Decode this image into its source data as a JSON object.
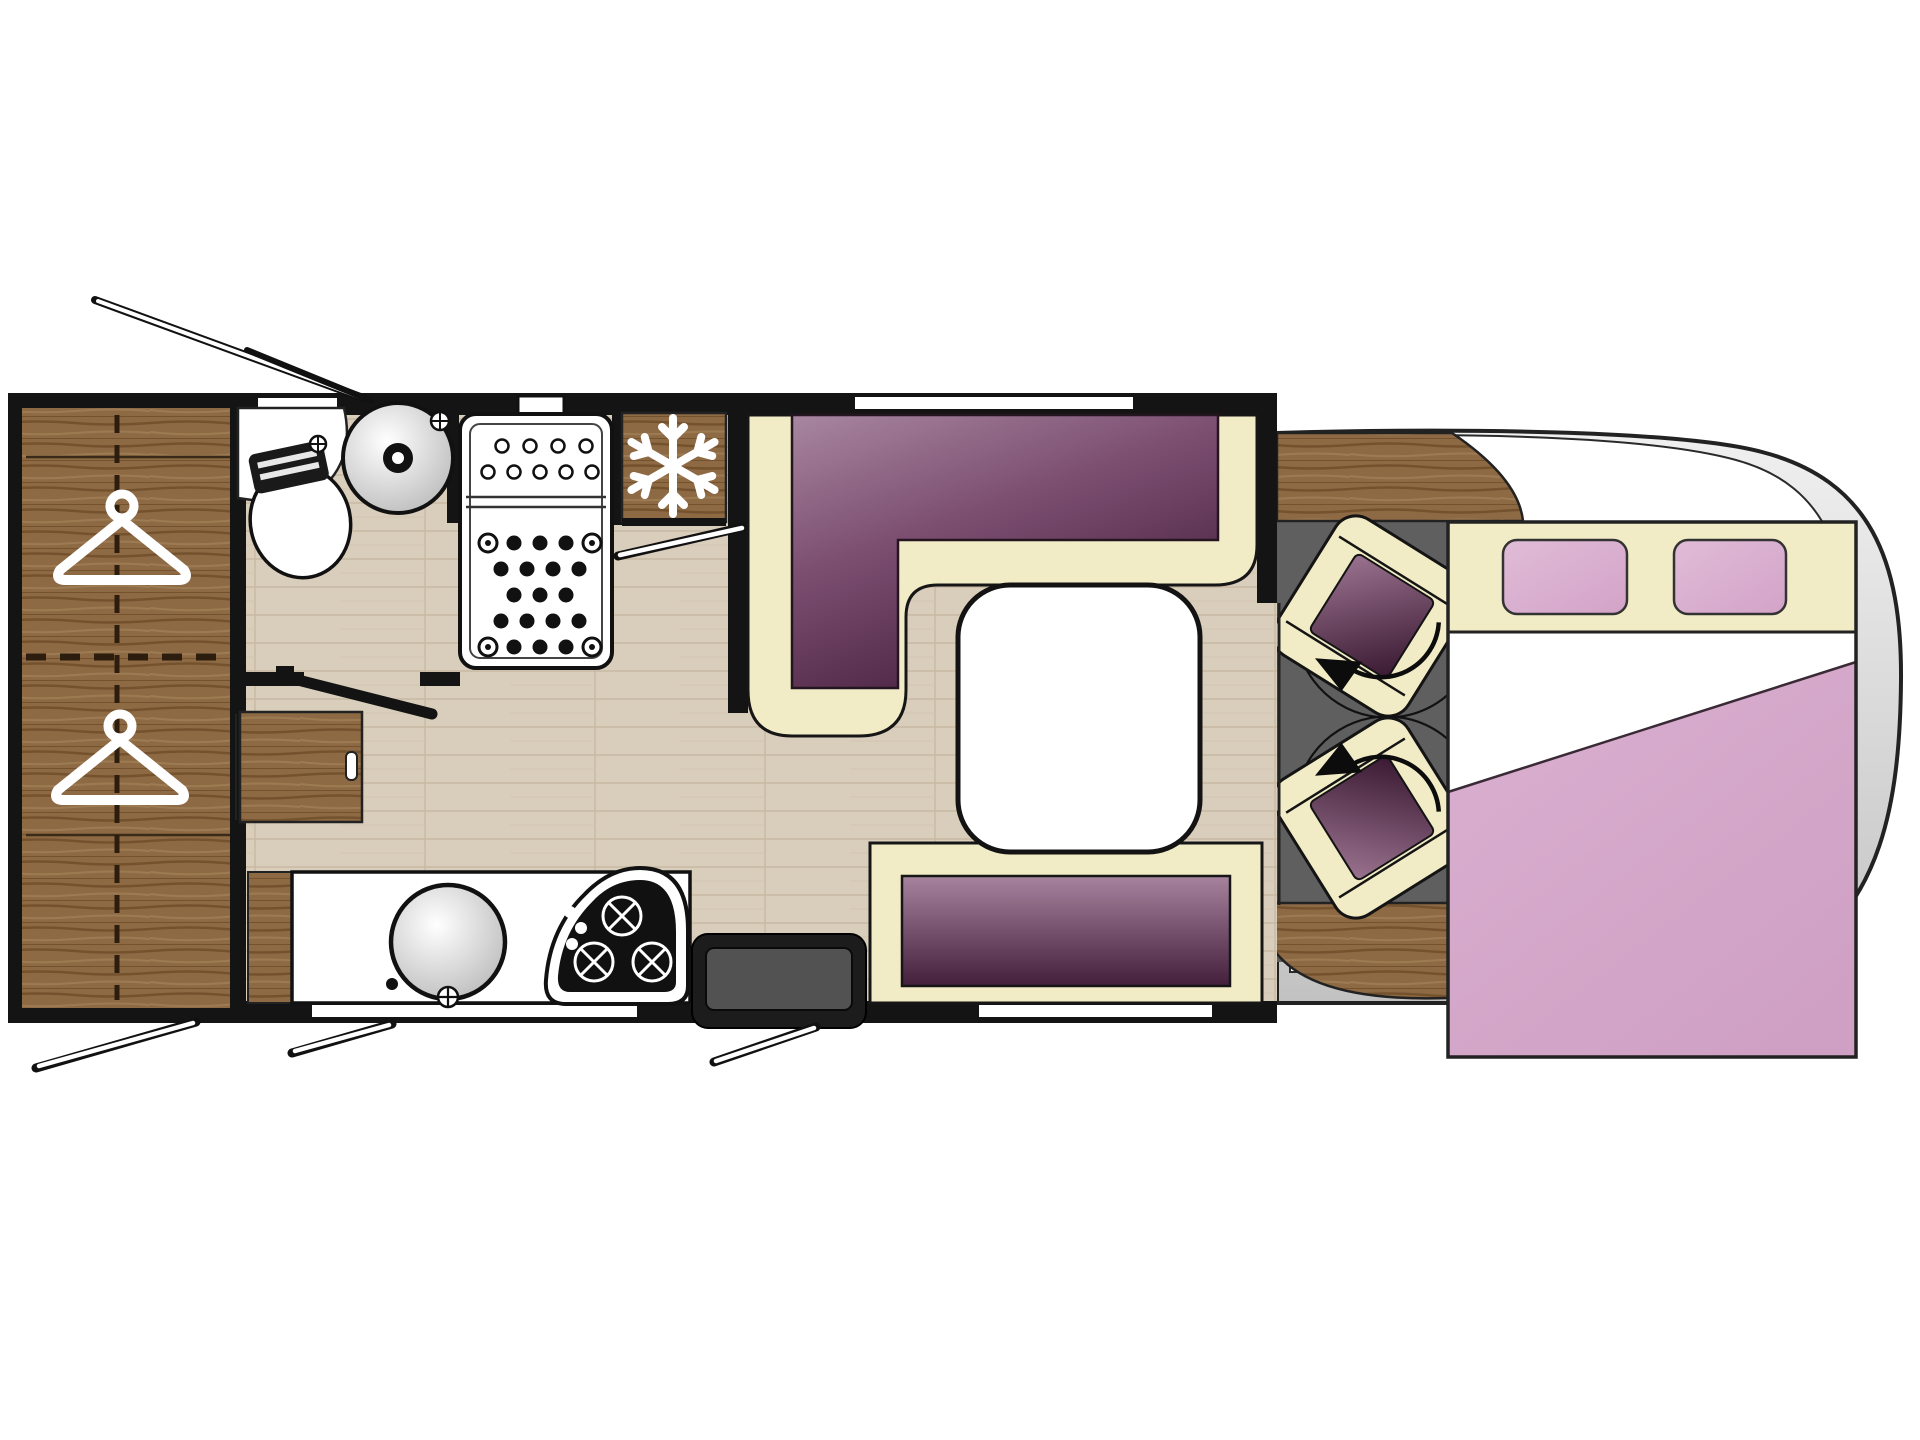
{
  "plan": {
    "type": "motorhome-floorplan",
    "view": "top-down",
    "zones": {
      "rear_wardrobe": {
        "label": "wardrobe",
        "hanger_icons": 2,
        "divider_style": "dashed"
      },
      "bathroom": {
        "fixtures": [
          "toilet",
          "washbasin"
        ],
        "door_swing": true
      },
      "shower": {
        "tray_sections": 2,
        "drain_dot_rows": 5
      },
      "kitchen": {
        "fixtures": [
          "refrigerator",
          "sink",
          "hob"
        ],
        "hob_burners": 3,
        "fridge_icon": "snowflake-icon",
        "counter_window": true
      },
      "dinette": {
        "sofa": "L-shaped lounge",
        "table": 1,
        "side_bench": 1,
        "window_over_sofa": true
      },
      "entrance": {
        "step": 1,
        "door_swing": true
      },
      "cab": {
        "swivel_seats": 2,
        "rotation_arrows": 2,
        "dashboard": true,
        "windshield": true
      },
      "overcab_bed": {
        "label": "double bed",
        "pillows": 2,
        "duvet": "pink",
        "headboard": "cream"
      }
    },
    "open_window_flaps": 4
  },
  "colors": {
    "wall": "#141414",
    "white": "#ffffff",
    "floor": "#d9cdbb",
    "floor_line": "#c8b9a3",
    "wood": "#8d6a44",
    "wood_dark": "#75522e",
    "wood_light": "#9d7b52",
    "cream": "#f2ecc6",
    "sofa_light": "#a886a0",
    "sofa_mid": "#7c4f71",
    "sofa_dark": "#47203f",
    "seat_light": "#9b7390",
    "seat_dark": "#391831",
    "bench_light": "#a8839e",
    "bench_dark": "#431f3c",
    "pillow_light": "#e0bcd7",
    "pillow_dark": "#d3a3c8",
    "duvet_light": "#dab0d0",
    "duvet_dark": "#cfa0c4",
    "headboard": "#f2ecc6",
    "body_gray_light": "#f0f0f0",
    "body_gray": "#c2c2c2",
    "cab_floor": "#5f5f5f",
    "step_dark": "#1c1c1c",
    "step_inner": "#525252",
    "basin_shade": "#b5b5b5",
    "outline": "#1a1a1a"
  }
}
